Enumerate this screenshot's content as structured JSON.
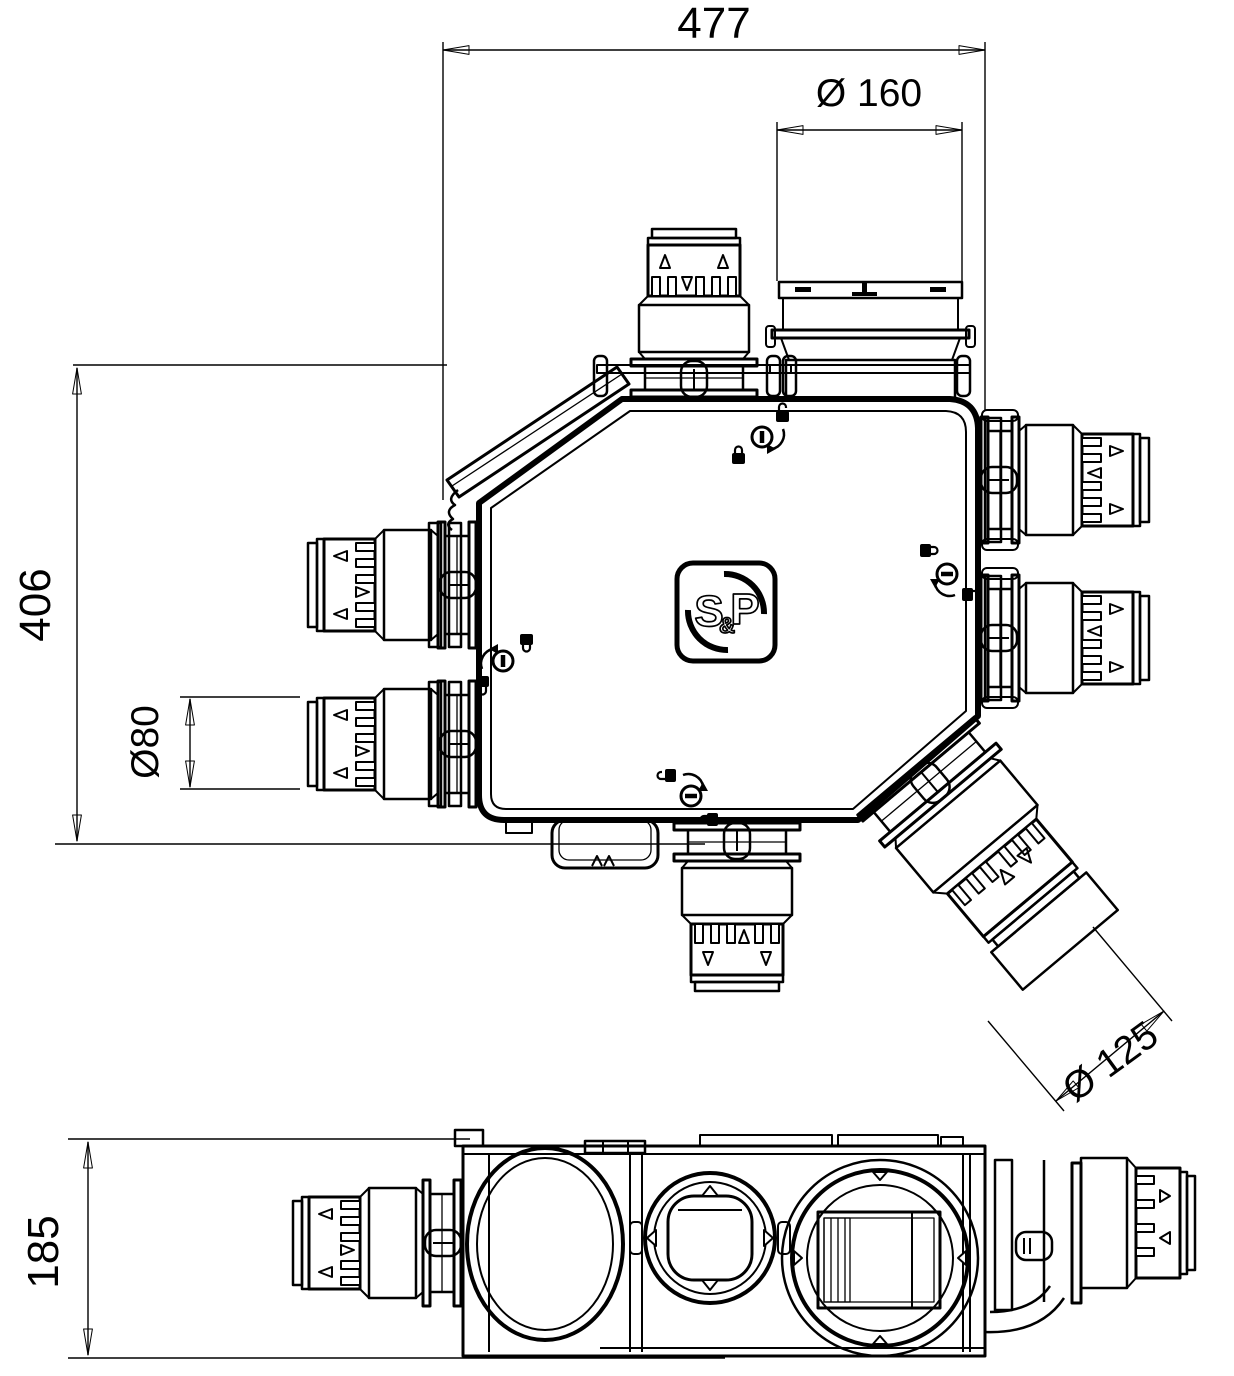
{
  "drawing": {
    "background_color": "#ffffff",
    "line_color": "#000000",
    "brand_logo": {
      "first": "S",
      "ampersand": "&",
      "second": "P"
    },
    "dimensions": {
      "overall_width": "477",
      "top_port_diameter": "Ø 160",
      "overall_height": "406",
      "small_port_diameter": "Ø80",
      "diagonal_port_diameter": "Ø 125",
      "body_depth": "185"
    }
  }
}
